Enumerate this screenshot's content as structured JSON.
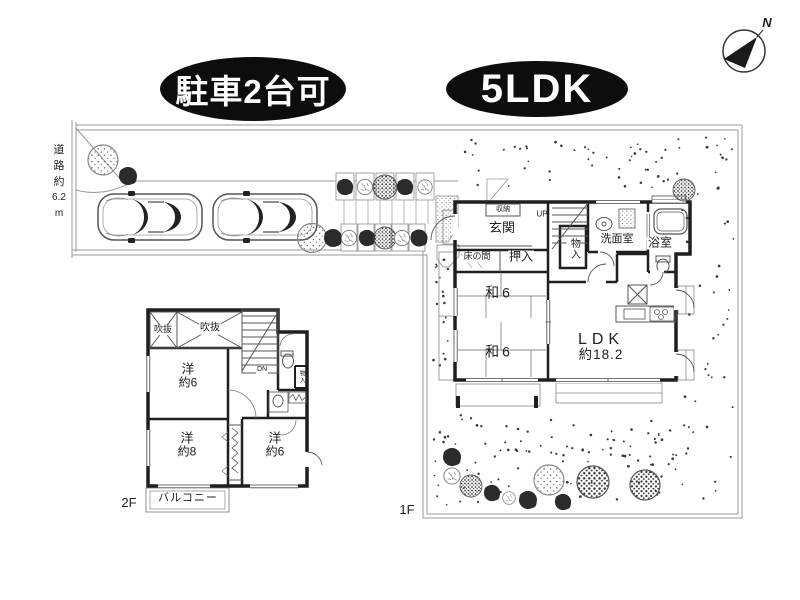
{
  "badges": [
    {
      "label": "駐車2台可"
    },
    {
      "label": "5LDK"
    }
  ],
  "compass": {
    "north": "N"
  },
  "site": {
    "road_lines": [
      "道",
      "路",
      "約",
      "6.2",
      "m"
    ],
    "floor_labels": {
      "first": "1F",
      "second": "2F"
    }
  },
  "floor1": {
    "closet_top": "収納",
    "entrance": "玄関",
    "stairs_up": "UP",
    "closet_hall": "物入",
    "washroom": "洗面室",
    "bathroom": "浴室",
    "tokonoma": "床の間",
    "oshiire": "押入",
    "tatami_room_1": "和6",
    "tatami_room_2": "和6",
    "ldk": [
      "LDK",
      "約18.2"
    ]
  },
  "floor2": {
    "void_1": "吹抜",
    "void_2": "吹抜",
    "stairs_down": "DN",
    "closet_small": "物入",
    "western_room_6a": [
      "洋",
      "約6"
    ],
    "western_room_8": [
      "洋",
      "約8"
    ],
    "western_room_6b": [
      "洋",
      "約6"
    ],
    "balcony": "バルコニー"
  },
  "colors": {
    "ink": "#1f1f1f",
    "badge_bg": "#0d0d0d",
    "badge_text": "#ffffff",
    "boundary": "#999999",
    "thin_line": "#555555"
  }
}
